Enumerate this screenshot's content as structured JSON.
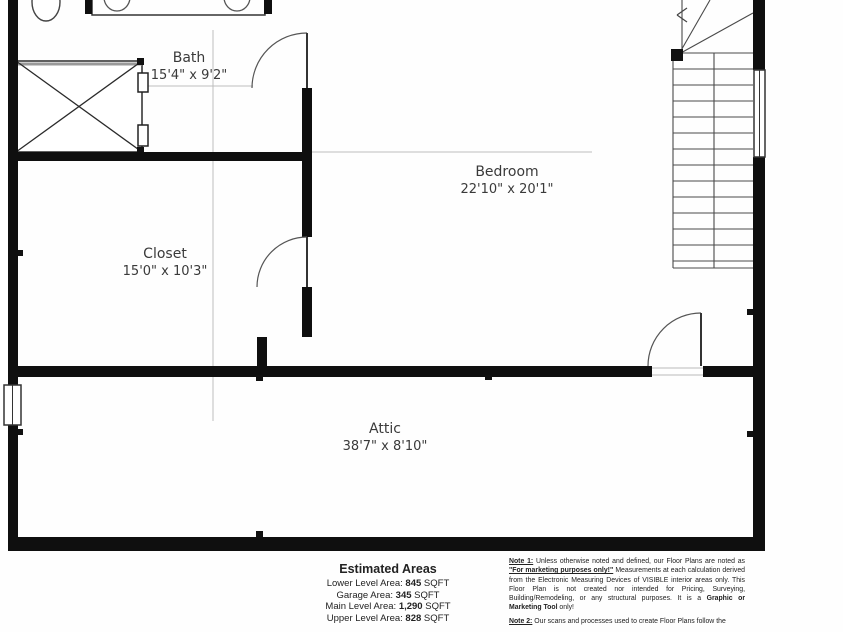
{
  "colors": {
    "wall": "#0f0f0f",
    "thin_line": "#4a4a4a",
    "faint_line": "#bdbdbd",
    "text": "#333333"
  },
  "plan": {
    "rooms": {
      "bath": {
        "name": "Bath",
        "dims": "15'4\" x 9'2\""
      },
      "bedroom": {
        "name": "Bedroom",
        "dims": "22'10\" x 20'1\""
      },
      "closet": {
        "name": "Closet",
        "dims": "15'0\" x 10'3\""
      },
      "attic": {
        "name": "Attic",
        "dims": "38'7\" x 8'10\""
      }
    }
  },
  "estimated_areas": {
    "title": "Estimated Areas",
    "rows": [
      {
        "label": "Lower Level Area:",
        "value": "845",
        "unit": "SQFT"
      },
      {
        "label": "Garage Area:",
        "value": "345",
        "unit": "SQFT"
      },
      {
        "label": "Main Level Area:",
        "value": "1,290",
        "unit": "SQFT"
      },
      {
        "label": "Upper Level Area:",
        "value": "828",
        "unit": "SQFT"
      }
    ]
  },
  "disclaimer": {
    "note1_label": "Note 1:",
    "note1_part1": " Unless otherwise noted and defined, our Floor Plans are noted as ",
    "note1_marketing": "\"For marketing purposes only!\"",
    "note1_part2": " Measurements at each calculation derived from the Electronic Measuring Devices of VISIBLE interior areas only. This Floor Plan is not created nor intended for Pricing, Surveying, Building/Remodeling, or any structural purposes. It is a ",
    "note1_tool": "Graphic or Marketing Tool",
    "note1_part3": " only!",
    "note2_label": "Note 2:",
    "note2_text": " Our scans and processes used to create Floor Plans follow the"
  }
}
